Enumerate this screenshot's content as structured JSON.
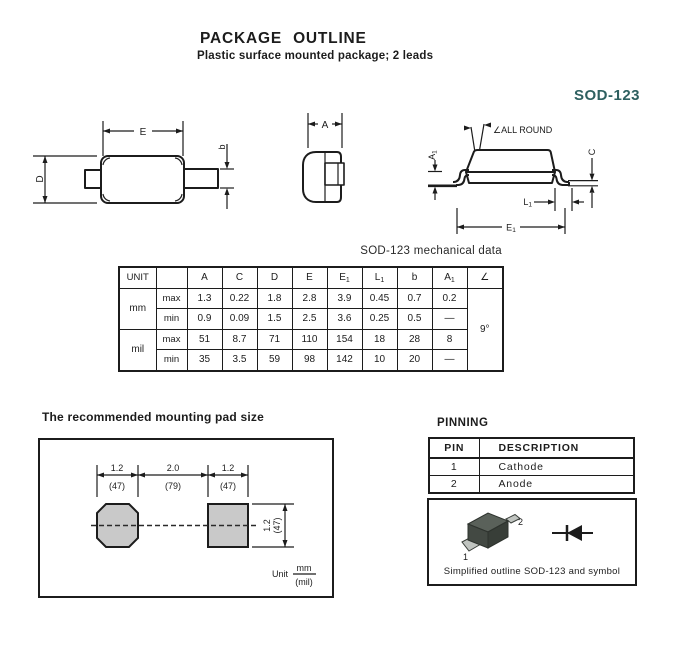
{
  "header": {
    "title": "PACKAGE OUTLINE",
    "subtitle": "Plastic surface mounted package; 2 leads",
    "package_name": "SOD-123",
    "package_name_color": "#2e6060"
  },
  "drawings": {
    "top_view": {
      "dim_e": "E",
      "dim_d": "D",
      "dim_b": "b"
    },
    "end_view": {
      "dim_a": "A"
    },
    "side_view": {
      "angle_note": "∠ALL ROUND",
      "dim_a1_base": "A",
      "dim_a1_sub": "1",
      "dim_c": "C",
      "dim_l1_base": "L",
      "dim_l1_sub": "1",
      "dim_e1_base": "E",
      "dim_e1_sub": "1"
    }
  },
  "mech_table": {
    "title": "SOD-123 mechanical data",
    "unit_header": "UNIT",
    "headers": [
      {
        "base": "A",
        "sub": ""
      },
      {
        "base": "C",
        "sub": ""
      },
      {
        "base": "D",
        "sub": ""
      },
      {
        "base": "E",
        "sub": ""
      },
      {
        "base": "E",
        "sub": "1"
      },
      {
        "base": "L",
        "sub": "1"
      },
      {
        "base": "b",
        "sub": ""
      },
      {
        "base": "A",
        "sub": "1"
      },
      {
        "base": "∠",
        "sub": ""
      }
    ],
    "units": [
      "mm",
      "mil"
    ],
    "bounds": [
      "max",
      "min"
    ],
    "rows": [
      {
        "values": [
          "1.3",
          "0.22",
          "1.8",
          "2.8",
          "3.9",
          "0.45",
          "0.7",
          "0.2"
        ]
      },
      {
        "values": [
          "0.9",
          "0.09",
          "1.5",
          "2.5",
          "3.6",
          "0.25",
          "0.5",
          "—"
        ]
      },
      {
        "values": [
          "51",
          "8.7",
          "71",
          "110",
          "154",
          "18",
          "28",
          "8"
        ]
      },
      {
        "values": [
          "35",
          "3.5",
          "59",
          "98",
          "142",
          "10",
          "20",
          "—"
        ]
      }
    ],
    "angle_value": "9°"
  },
  "mounting_pad": {
    "title": "The recommended mounting pad size",
    "dims_top": [
      {
        "mm": "1.2",
        "mil": "(47)"
      },
      {
        "mm": "2.0",
        "mil": "(79)"
      },
      {
        "mm": "1.2",
        "mil": "(47)"
      }
    ],
    "dim_right": {
      "mm": "1.2",
      "mil": "(47)"
    },
    "unit": {
      "label": "Unit",
      "numerator": "mm",
      "denominator": "(mil)"
    }
  },
  "pinning": {
    "title": "PINNING",
    "col_pin": "PIN",
    "col_description": "DESCRIPTION",
    "rows": [
      {
        "pin": "1",
        "description": "Cathode"
      },
      {
        "pin": "2",
        "description": "Anode"
      }
    ]
  },
  "outline_box": {
    "pin1_label": "1",
    "pin2_label": "2",
    "caption": "Simplified outline SOD-123 and symbol"
  }
}
